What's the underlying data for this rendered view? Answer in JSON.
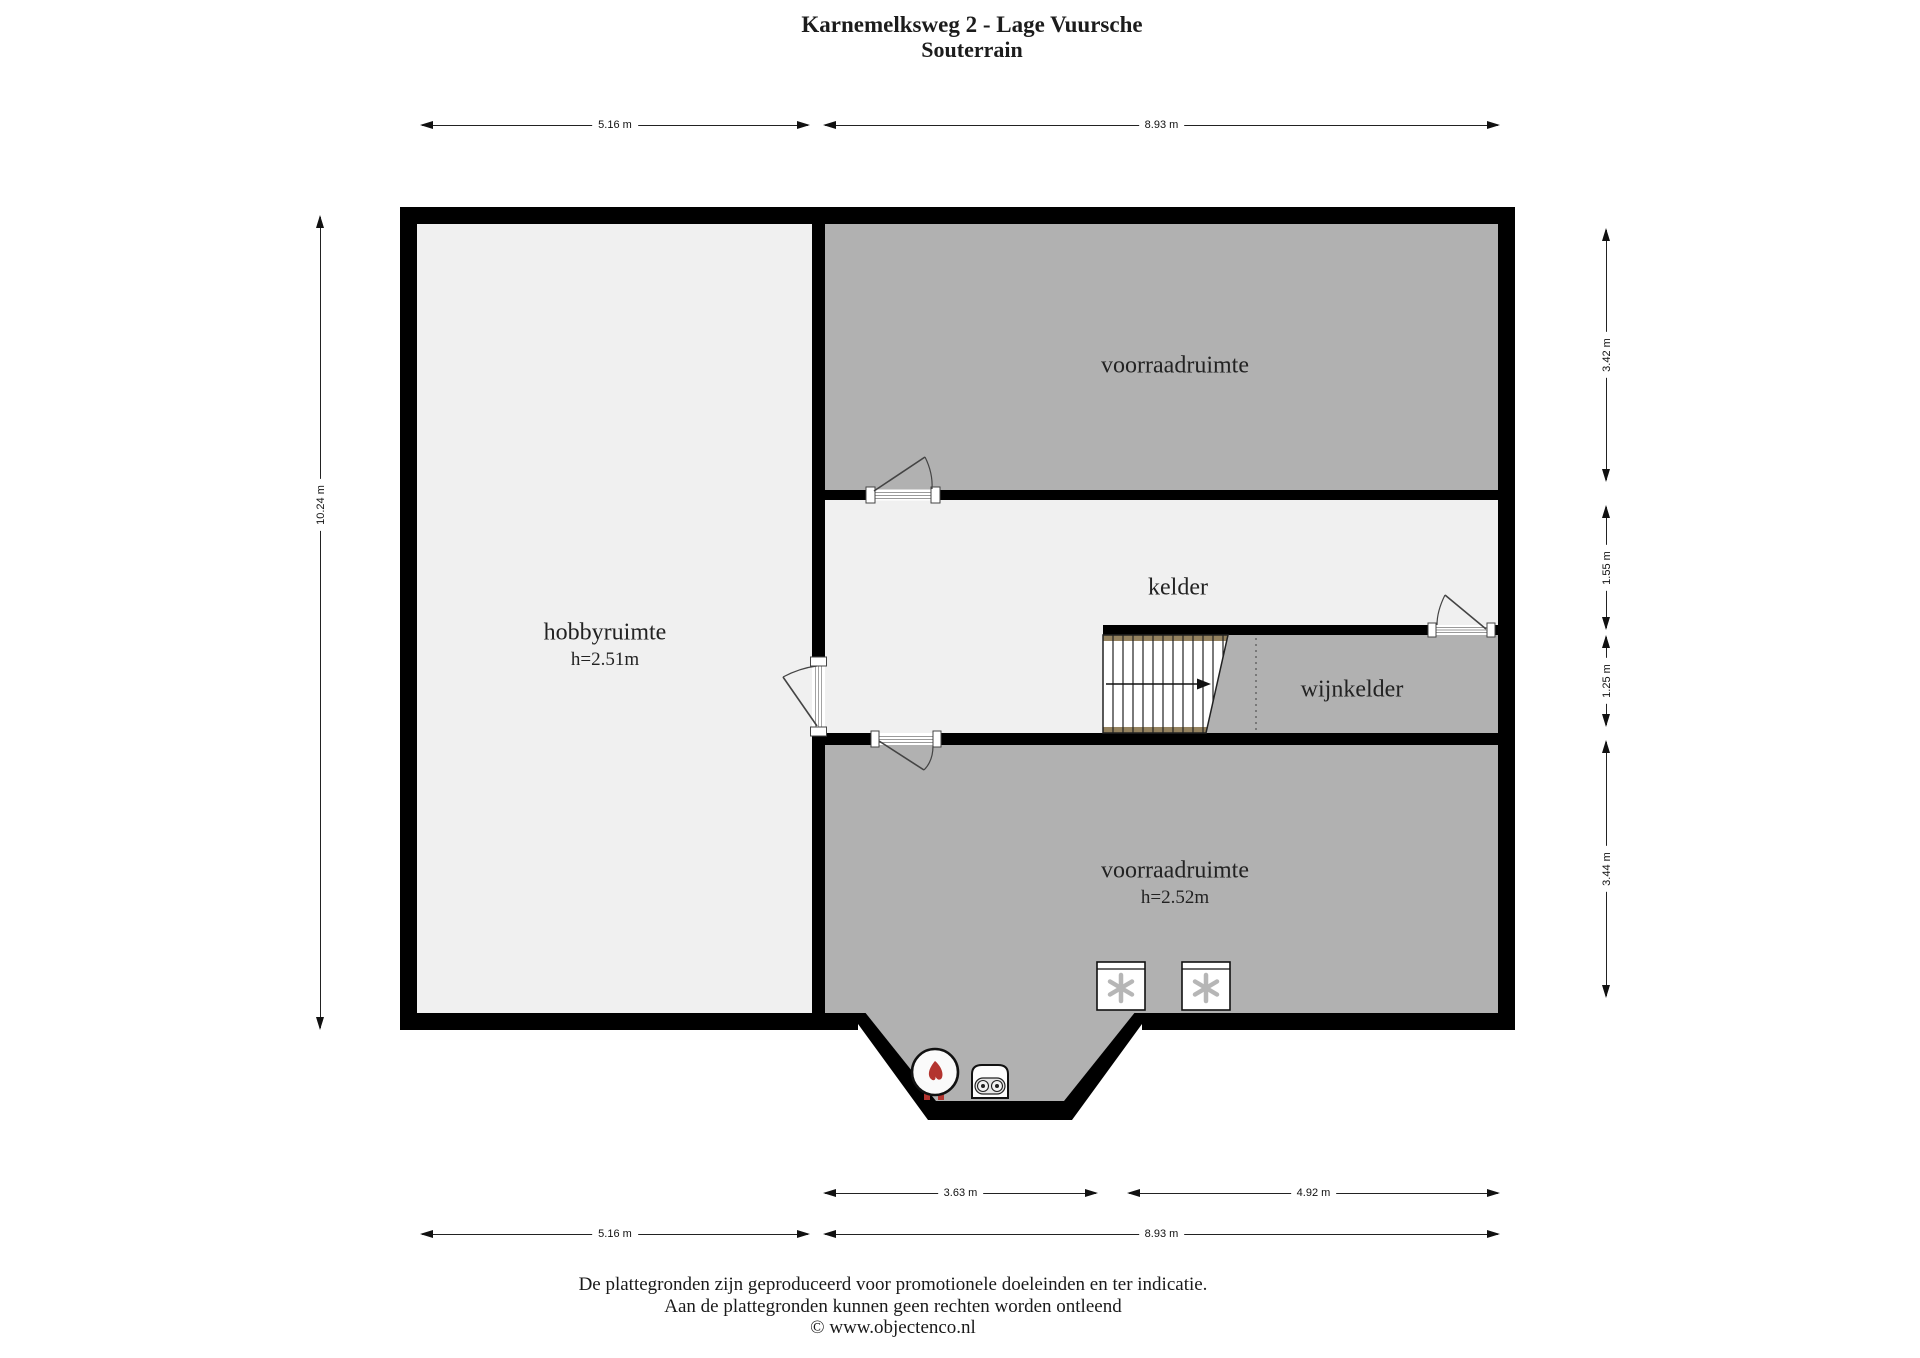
{
  "title": {
    "line1": "Karnemelksweg 2 - Lage Vuursche",
    "line2": "Souterrain"
  },
  "rooms": {
    "hobbyruimte": {
      "label": "hobbyruimte",
      "height": "h=2.51m"
    },
    "voorraadruimte_top": {
      "label": "voorraadruimte"
    },
    "kelder": {
      "label": "kelder"
    },
    "wijnkelder": {
      "label": "wijnkelder"
    },
    "voorraadruimte_bottom": {
      "label": "voorraadruimte",
      "height": "h=2.52m"
    }
  },
  "dimensions": {
    "top": [
      "5.16 m",
      "8.93 m"
    ],
    "left": [
      "10.24 m"
    ],
    "right": [
      "3.42 m",
      "1.55 m",
      "1.25 m",
      "3.44 m"
    ],
    "bottom_upper": [
      "3.63 m",
      "4.92 m"
    ],
    "bottom_lower": [
      "5.16 m",
      "8.93 m"
    ]
  },
  "symbols": {
    "freezer_left": "asterisk-appliance-icon",
    "freezer_right": "asterisk-appliance-icon",
    "boiler": "boiler-flame-icon",
    "pump": "pump-unit-icon",
    "stairs": "staircase-down",
    "door_swings": 4
  },
  "footer": {
    "line1": "De plattegronden zijn geproduceerd voor promotionele doeleinden en ter indicatie.",
    "line2": "Aan de plattegronden kunnen geen rechten worden ontleend",
    "line3": "© www.objectenco.nl"
  },
  "colors": {
    "room_dark": "#b1b1b1",
    "room_light": "#f0f0f0",
    "wall": "#000000",
    "stair_wood": "#94825f",
    "flame_red": "#b3342f"
  }
}
